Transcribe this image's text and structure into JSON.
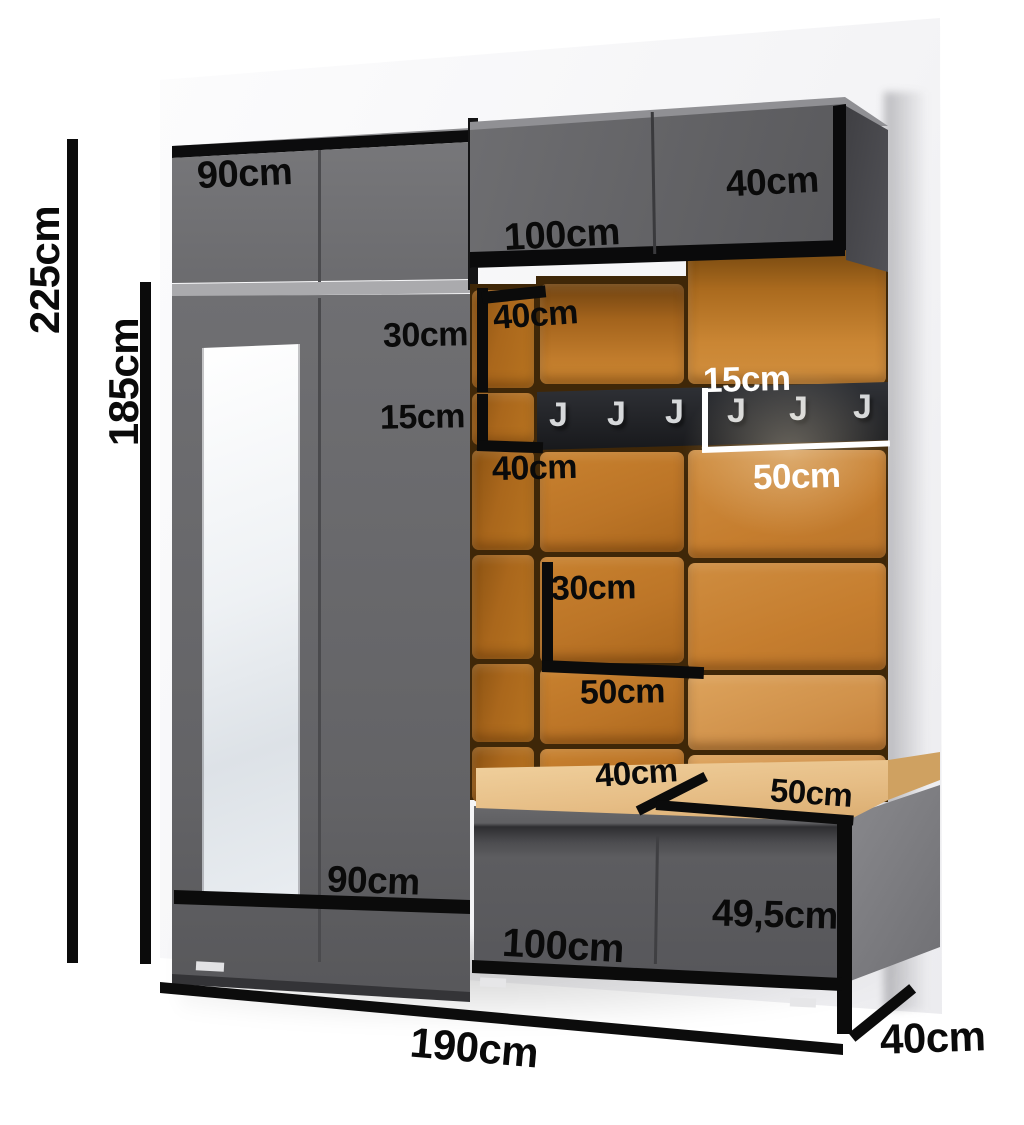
{
  "image": {
    "description": "3D render of a graphite hallway furniture set with orange upholstered wall panels, coat hook rail, mirror wardrobe and shoe bench, annotated with dimensions",
    "background": "#ffffff"
  },
  "colors": {
    "cabinet_gray": "#6b6b6e",
    "cabinet_edge_black": "#0b0b0c",
    "panel_orange": "#c07b2e",
    "rail_black": "#1d1e21",
    "hook_silver": "#d6d8da",
    "cushion_tan": "#ecc794",
    "mirror_white": "#eef1f4",
    "wall_white": "#f6f6f8",
    "dimension_black": "#0b0b0b",
    "dimension_white": "#ffffff"
  },
  "dimensions": {
    "overall_height": "225cm",
    "wardrobe_height": "185cm",
    "top_cabinet_width": "90cm",
    "wall_cabinet_width": "100cm",
    "wall_cabinet_right_width": "40cm",
    "panel_top_width": "40cm",
    "panel_top_height": "30cm",
    "hook_panel_height_label": "15cm",
    "panel_mid_width": "40cm",
    "rail_height": "15cm",
    "hook_panel_width": "50cm",
    "panel_lower_height": "30cm",
    "panel_lower_width": "50cm",
    "seat_left_width": "40cm",
    "seat_right_width": "50cm",
    "bench_width": "100cm",
    "bench_height": "49,5cm",
    "wardrobe_width": "90cm",
    "total_width": "190cm",
    "total_depth": "40cm"
  },
  "hooks": {
    "glyph": "J",
    "count": 6
  }
}
